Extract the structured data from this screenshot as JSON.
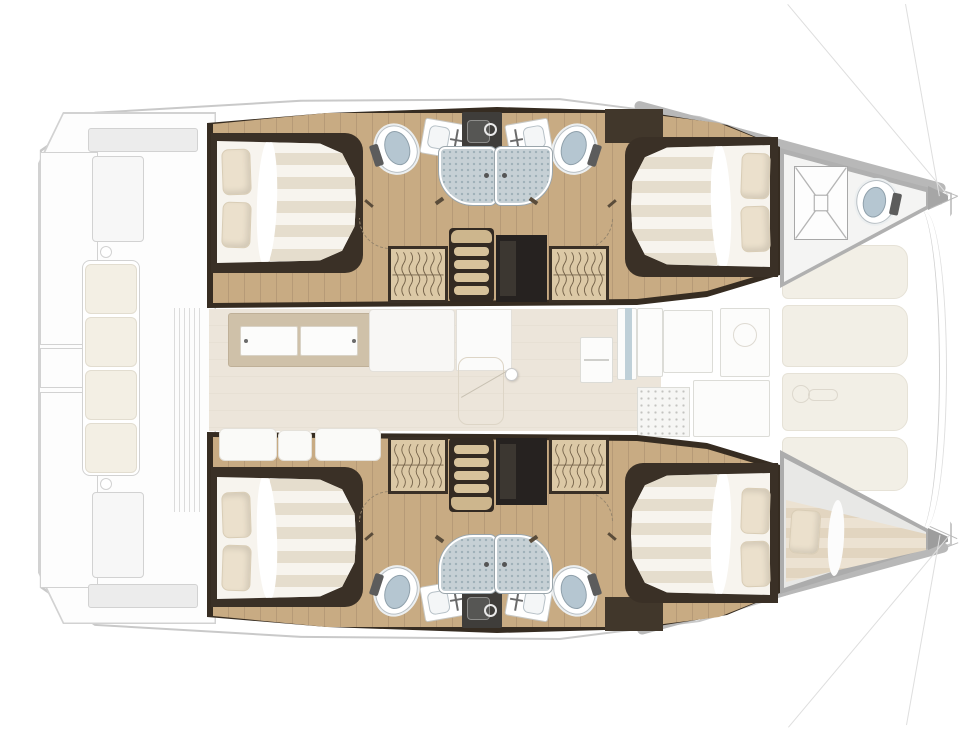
{
  "vessel": {
    "kind": "catamaran-interior-floorplan",
    "orientation": "bow-right",
    "decks": "lower-accommodation-solid, main-deck-faded"
  },
  "palette": {
    "trim-dark": "#362c21",
    "furniture-dark": "#3a3026",
    "wood": "#c8ab83",
    "wood-line": "#b69a77",
    "step-wood": "#d7c29b",
    "wardrobe-wood": "#dcc9a6",
    "bed-white": "#f7f4ee",
    "bed-stripe": "#e5ddcd",
    "pillow": "#ebe0cc",
    "shower-tray": "#c6d0d5",
    "shower-dot": "#9fb0b8",
    "toilet-lid": "#b5c6d1",
    "porcelain": "#ffffff",
    "landing-dark": "#262220",
    "cabinet-gray": "#3f3d3a",
    "saloon-floor": "#ece5da",
    "panel-cream": "#f2efe6",
    "deck-line": "#c9c9c9",
    "sketch-line": "#d2d2d2",
    "gunwale": "#b8b8b8",
    "gray-wall": "#b0b0b0",
    "cushion-cream": "#f3efe4"
  },
  "hulls": [
    {
      "name": "port-hull-interior"
    },
    {
      "name": "starboard-hull-interior"
    }
  ],
  "rooms": {
    "cockpit": "aft-cockpit",
    "saloon": "saloon",
    "galley": "galley",
    "foredeck": "foredeck-lockers",
    "aftCabin": "aft-double-cabin",
    "fwdCabin": "forward-double-cabin",
    "aftBath": "aft-bathroom",
    "fwdBath": "forward-bathroom",
    "forepeakPort": "bow-crew-compartment",
    "forepeakStbd": "bow-skipper-berth"
  },
  "fixtures": {
    "double_bed": "double-bed",
    "pillow": "pillow",
    "toilet": "marine-toilet",
    "vanity": "sink-vanity",
    "shower": "shower-cubicle",
    "wardrobe": "hanging-wardrobe",
    "companionway": "companionway-steps",
    "hatch": "deck-hatch",
    "skipper_berth": "single-berth",
    "bench": "cockpit-bench-seat",
    "sideboard": "saloon-sideboard",
    "sofa": "saloon-sofa",
    "door_knob": "saloon-door-knob",
    "windlass": "anchor-windlass",
    "trampoline": "trampoline-front-edge",
    "rigging": "rigging-line",
    "sliding_door": "cockpit-sliding-door"
  }
}
